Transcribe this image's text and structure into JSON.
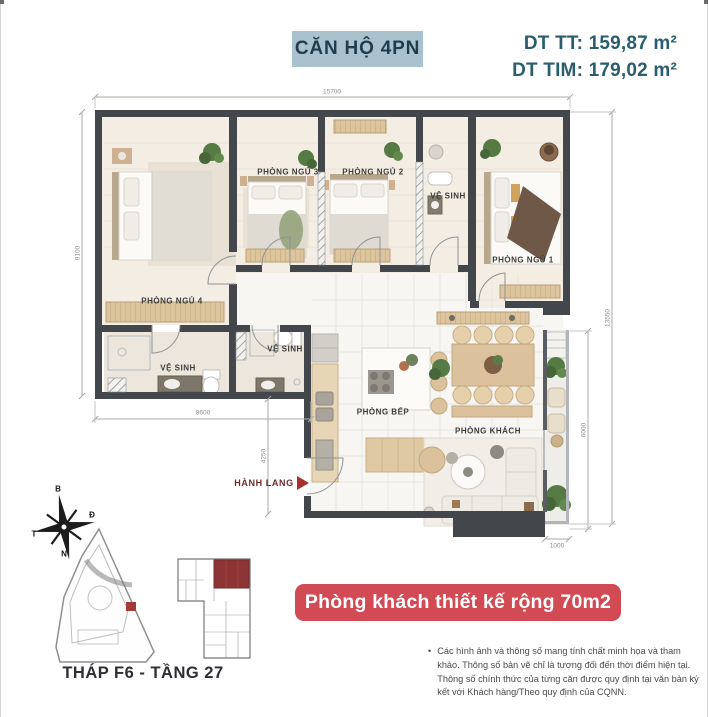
{
  "header": {
    "unit_type_badge": "CĂN HỘ 4PN",
    "area_line1": "DT TT: 159,87 m²",
    "area_line2": "DT TIM: 179,02 m²"
  },
  "plan": {
    "labels": {
      "bedroom4": "PHÒNG NGỦ 4",
      "bedroom3": "PHÒNG NGỦ 3",
      "bedroom2": "PHÒNG NGỦ 2",
      "bedroom1": "PHÒNG NGỦ 1",
      "bath_top": "VỆ SINH",
      "bath_left": "VỆ SINH",
      "bath_mid": "VỆ SINH",
      "kitchen": "PHÒNG BẾP",
      "living": "PHÒNG KHÁCH",
      "hallway": "HÀNH LANG"
    },
    "dimensions": {
      "top": "15700",
      "left": "9100",
      "wing_bottom": "8600",
      "hallway": "4250",
      "balcony": "6000",
      "right": "13550",
      "balcony_bottom": "1000"
    }
  },
  "compass": {
    "north": "B",
    "east": "Đ",
    "west": "T",
    "south": "N"
  },
  "keyplan": {
    "caption": "THÁP F6 - TẦNG 27"
  },
  "banner": {
    "text": "Phòng khách thiết kế rộng 70m2"
  },
  "disclaimer": {
    "bullet": "•",
    "text": "Các hình ảnh và thông số mang tính chất minh họa và tham khảo. Thông số bản vẽ chỉ là tương đối đến thời điểm hiện tại. Thông số chính thức của từng căn được quy định tại văn bản ký kết với Khách hàng/Theo quy định của CQNN."
  },
  "colors": {
    "teal_text": "#2a5e6d",
    "badge_bg": "#a9c2cd",
    "banner_red": "#d24a54",
    "wall_dark": "#43474b",
    "highlight_red": "#8e3434"
  }
}
